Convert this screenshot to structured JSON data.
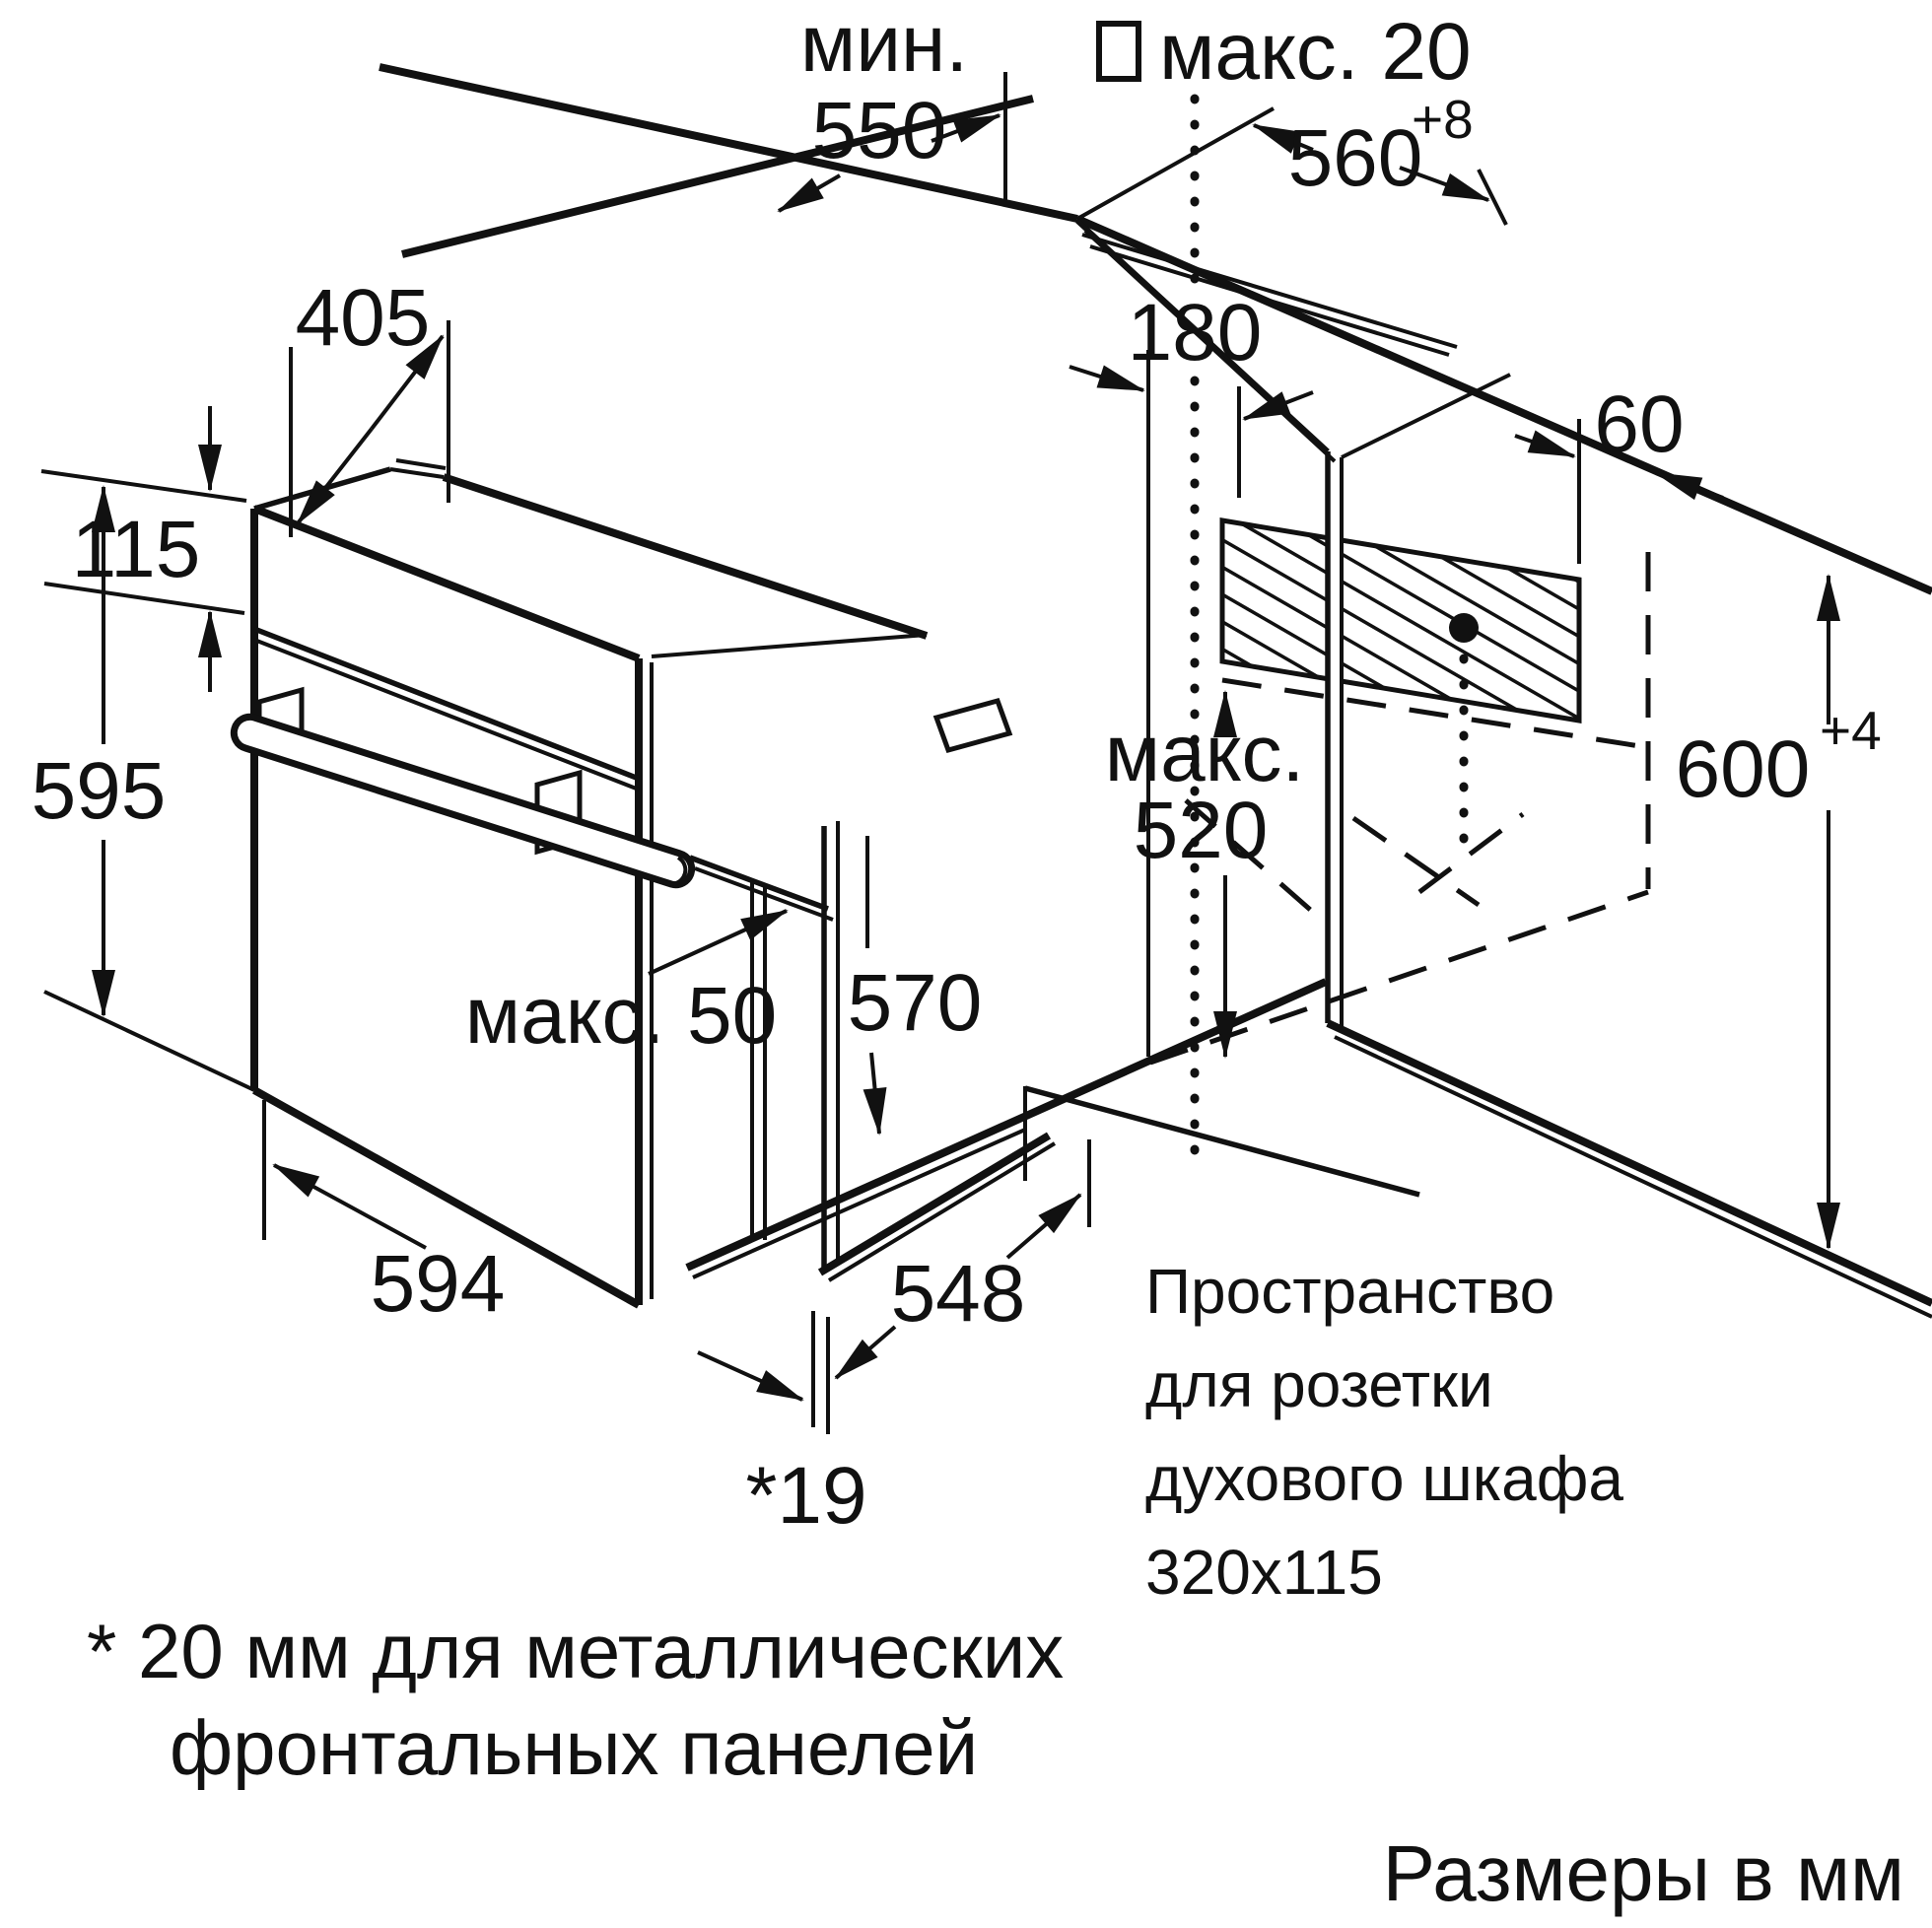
{
  "dims": {
    "min550": {
      "prefix": "мин.",
      "value": "550"
    },
    "max20": {
      "label": "макс. 20"
    },
    "w560": {
      "value": "560",
      "tolerance": "+8"
    },
    "d405": "405",
    "d115": "115",
    "d595": "595",
    "d180": "180",
    "d60": "60",
    "max520": {
      "line1": "макс.",
      "line2": "520"
    },
    "h600": {
      "value": "600",
      "tolerance": "+4"
    },
    "d570": "570",
    "max50": "макс. 50",
    "d594": "594",
    "d548": "548",
    "front19": "*19"
  },
  "socket_note": {
    "line1": "Пространство",
    "line2": "для розетки",
    "line3": "духового шкафа",
    "line4": "320x115"
  },
  "footnote": {
    "line1": "* 20 мм для металлических",
    "line2": "фронтальных панелей"
  },
  "units_note": "Размеры в мм",
  "colors": {
    "line": "#111111",
    "background": "#ffffff"
  }
}
